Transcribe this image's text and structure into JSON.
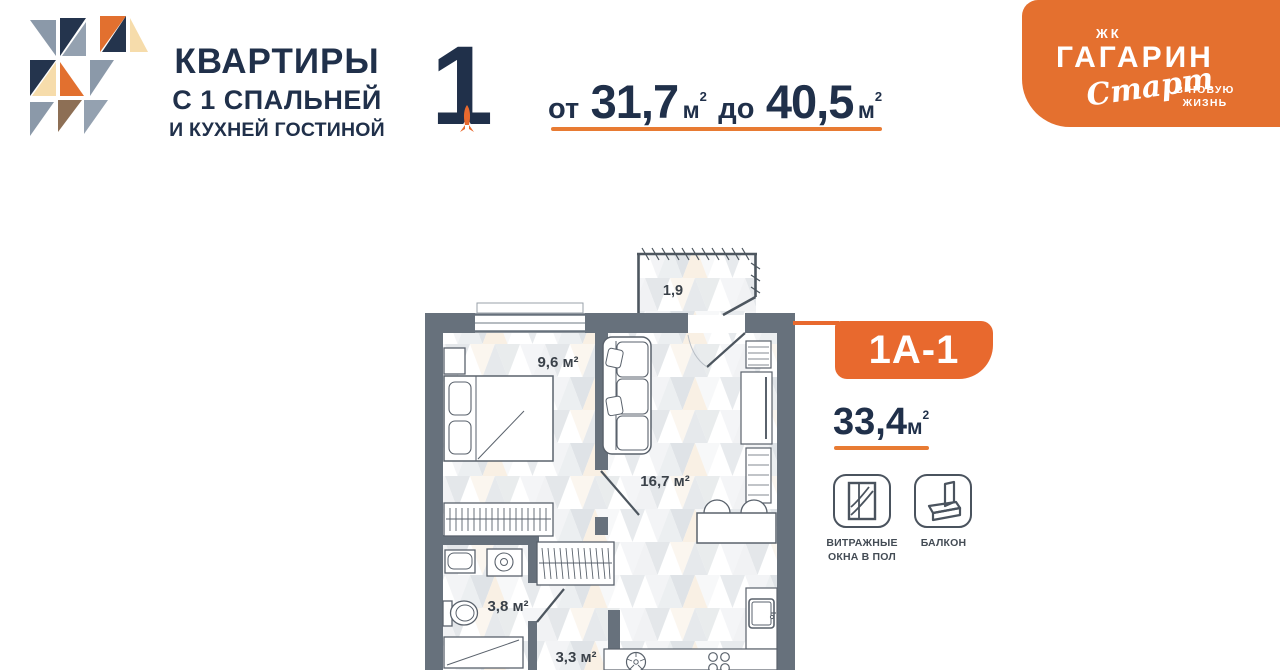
{
  "header": {
    "title_line1": "КВАРТИРЫ",
    "title_line2": "С 1 СПАЛЬНЕЙ",
    "title_line3": "И КУХНЕЙ ГОСТИНОЙ",
    "big_digit": "1",
    "range": {
      "from_label": "от",
      "from_value": "31,7",
      "to_label": "до",
      "to_value": "40,5",
      "unit": "м",
      "unit_sup": "2"
    }
  },
  "brand": {
    "complex_type": "ЖК",
    "name": "ГАГАРИН",
    "script": "Старт",
    "tagline_line1": "В НОВУЮ",
    "tagline_line2": "ЖИЗНЬ"
  },
  "plan": {
    "unit_code": "1А-1",
    "area_value": "33,4",
    "area_unit": "м",
    "area_sup": "2",
    "rooms": [
      {
        "name": "bedroom",
        "label": "9,6 м²"
      },
      {
        "name": "living-kitchen",
        "label": "16,7 м²"
      },
      {
        "name": "bathroom",
        "label": "3,8 м²"
      },
      {
        "name": "hall",
        "label": "3,3 м²"
      },
      {
        "name": "balcony",
        "label": "1,9"
      }
    ],
    "features": [
      {
        "icon": "panoramic-window-icon",
        "label_line1": "ВИТРАЖНЫЕ",
        "label_line2": "ОКНА В ПОЛ"
      },
      {
        "icon": "balcony-icon",
        "label_line1": "БАЛКОН",
        "label_line2": ""
      }
    ]
  },
  "colors": {
    "accent": "#E8692E",
    "navy": "#20304A",
    "wall": "#67717C"
  }
}
